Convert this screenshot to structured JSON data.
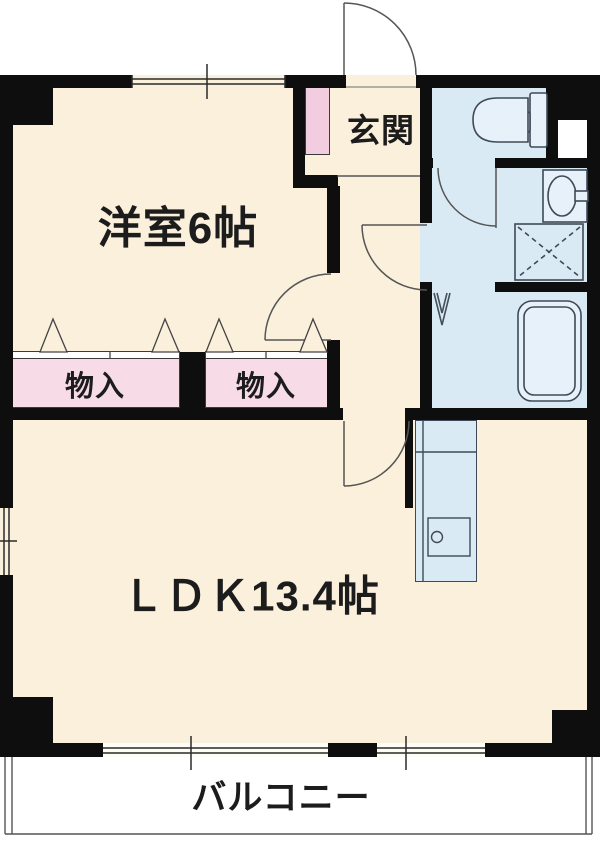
{
  "labels": {
    "western_room": "洋室6帖",
    "entrance": "玄関",
    "closet_1": "物入",
    "closet_2": "物入",
    "ldk": "ＬＤＫ13.4帖",
    "balcony": "バルコニー"
  },
  "colors": {
    "wall": "#0e0e0e",
    "floor": "#faf0dc",
    "wet_area": "#daeaf5",
    "closet_pink": "#f7dce8",
    "shoebox_pink": "#f2cddf",
    "fixture_line": "#3e4a57",
    "door_line": "#555555",
    "balcony": "#ffffff",
    "text": "#1c1c1c"
  }
}
